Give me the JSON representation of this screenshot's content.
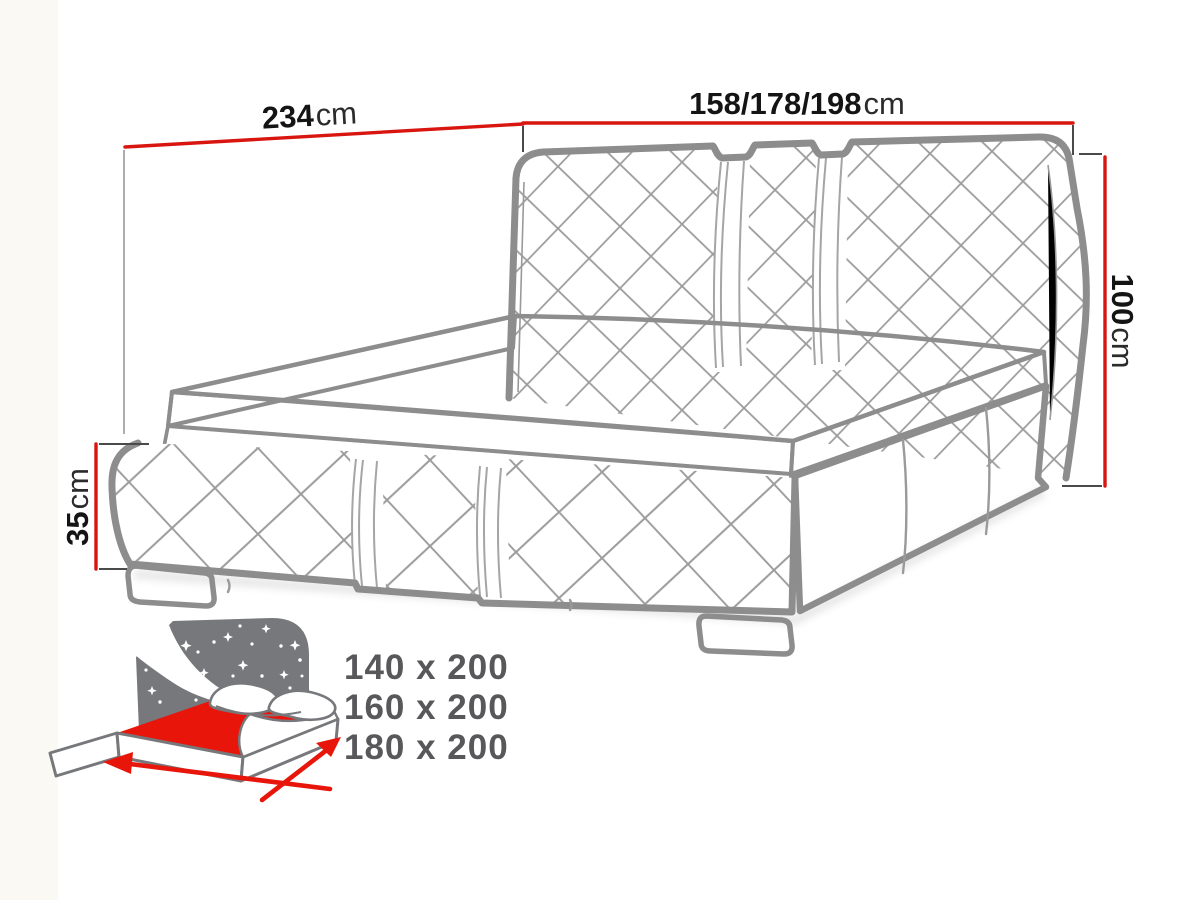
{
  "dimension_labels": {
    "top_left": {
      "value": "234",
      "unit": "cm"
    },
    "top_right": {
      "value": "158/178/198",
      "unit": "cm"
    },
    "right_side": {
      "value": "100",
      "unit": "cm"
    },
    "left_side": {
      "value": "35",
      "unit": "cm"
    }
  },
  "size_options": {
    "items": [
      "140 x 200",
      "160 x 200",
      "180 x 200"
    ]
  },
  "colors": {
    "dimension_line_red": "#d9150f",
    "icon_red": "#e8150b",
    "outline_gray": "#8d8d8d",
    "icon_gray": "#77787b",
    "size_text_gray": "#58585b"
  }
}
